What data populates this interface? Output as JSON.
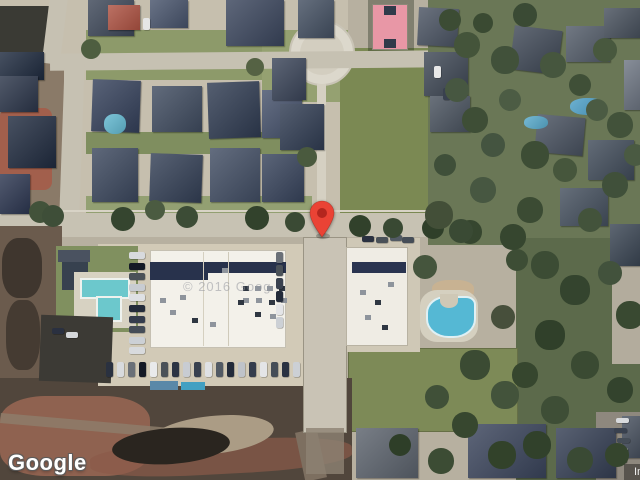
{
  "map": {
    "logo_text": "Google",
    "attribution_text": "Imagery ©2026 Airbus, Maxar Technologies, Vexcel Imaging US, Inc.",
    "roof_watermark_text": "© 2016 Goog"
  },
  "marker": {
    "color": "#EA4335",
    "inner_color": "#B3261E"
  },
  "colors": {
    "ground": "#b7b0a0",
    "residential_ground": "#c6bfae",
    "road": "#c6c1b2",
    "grass_field": "#7b8953",
    "lawn": "#8d9a6a",
    "trees_base": "#6a7756",
    "dirt_dark": "#51463c",
    "dirt_red": "#9a6753",
    "pool_teal": "#6cc8cc",
    "pool_blue": "#55b8d4",
    "court_pink": "#e897a6",
    "building_white": "#f3f1ea",
    "building_navy": "#28324c"
  }
}
